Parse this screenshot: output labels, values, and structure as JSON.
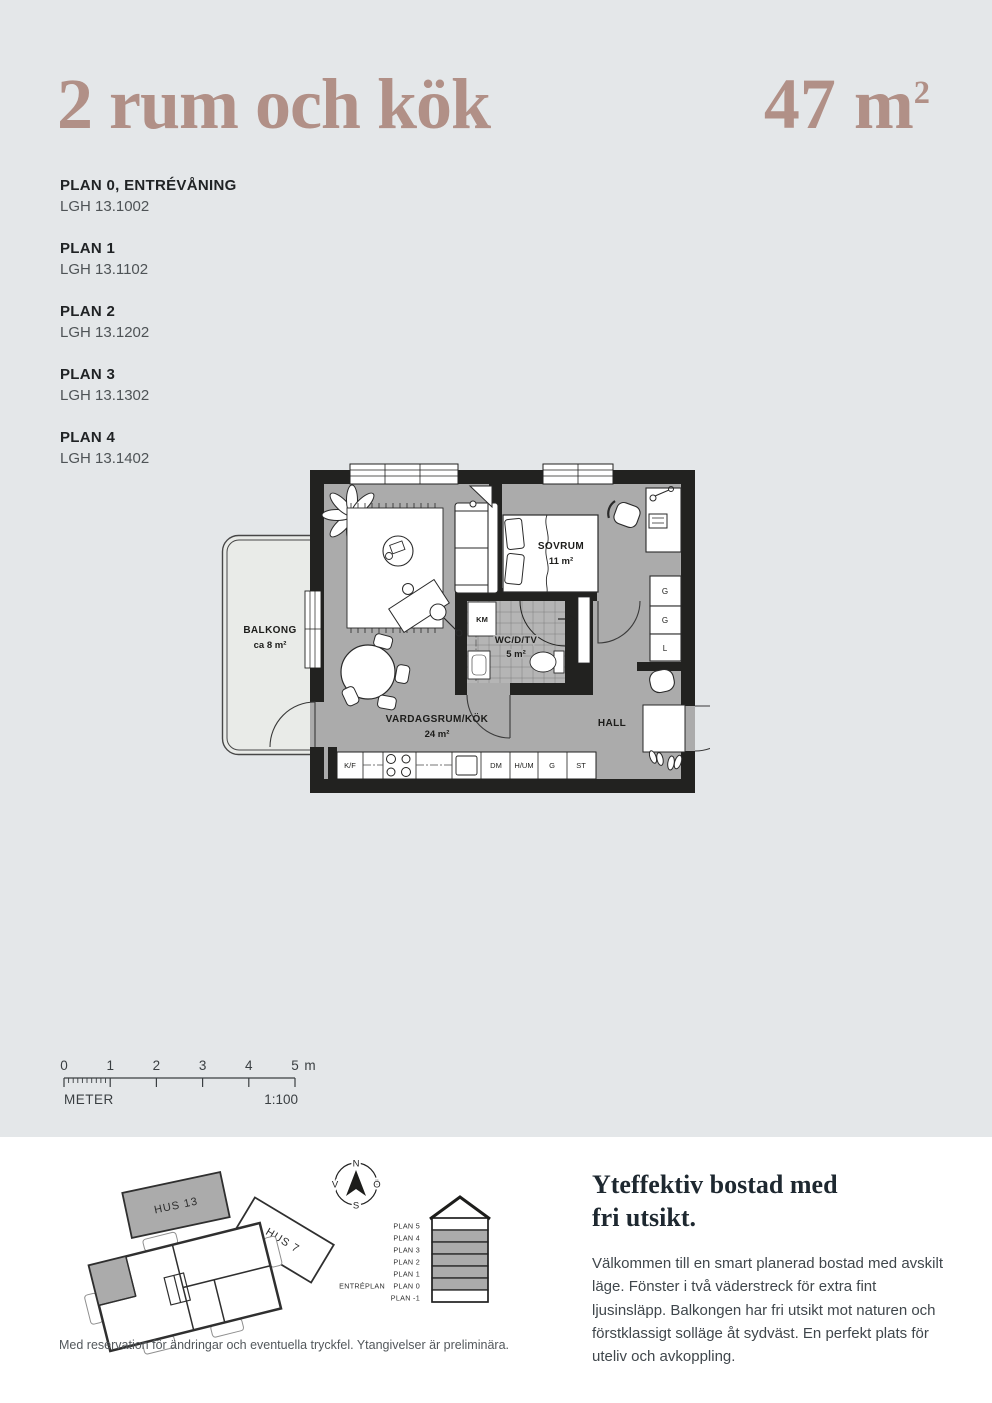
{
  "page": {
    "bg_top": "#e4e7e9",
    "bg_bottom": "#ffffff",
    "accent": "#b19087"
  },
  "header": {
    "title": "2 rum och kök",
    "area_value": "47 m",
    "area_sup": "2"
  },
  "plan_list": [
    {
      "plan": "PLAN 0, ENTRÉVÅNING",
      "lgh": "LGH 13.1002"
    },
    {
      "plan": "PLAN 1",
      "lgh": "LGH 13.1102"
    },
    {
      "plan": "PLAN 2",
      "lgh": "LGH 13.1202"
    },
    {
      "plan": "PLAN 3",
      "lgh": "LGH 13.1302"
    },
    {
      "plan": "PLAN 4",
      "lgh": "LGH 13.1402"
    }
  ],
  "floorplan": {
    "balkong_label": "BALKONG",
    "balkong_area": "ca 8 m²",
    "sovrum_label": "SOVRUM",
    "sovrum_area": "11 m²",
    "wc_label": "WC/D/TV",
    "wc_area": "5 m²",
    "vardagsrum_label": "VARDAGSRUM/KÖK",
    "vardagsrum_area": "24 m²",
    "hall_label": "HALL",
    "km_label": "KM",
    "closets": [
      "G",
      "G",
      "L"
    ],
    "kitchen_units": [
      "K/F",
      "DM",
      "H/UM",
      "G",
      "ST"
    ],
    "colors": {
      "wall": "#222220",
      "floor": "#ababab",
      "balcony": "#e9ebe8",
      "tile": "#b5b5b5"
    }
  },
  "scalebar": {
    "ticks": [
      "0",
      "1",
      "2",
      "3",
      "4",
      "5"
    ],
    "unit": "m",
    "meter_label": "METER",
    "ratio_label": "1:100"
  },
  "site_plan": {
    "hus13_label": "HUS 13",
    "hus7_label": "HUS 7"
  },
  "compass": {
    "north": "N",
    "east": "Ö",
    "south": "S",
    "west": "V"
  },
  "section": {
    "entry_label": "ENTRÉPLAN",
    "floors": [
      {
        "label": "PLAN 5",
        "highlighted": false
      },
      {
        "label": "PLAN 4",
        "highlighted": true
      },
      {
        "label": "PLAN 3",
        "highlighted": true
      },
      {
        "label": "PLAN 2",
        "highlighted": true
      },
      {
        "label": "PLAN 1",
        "highlighted": true
      },
      {
        "label": "PLAN 0",
        "highlighted": true
      },
      {
        "label": "PLAN -1",
        "highlighted": false
      }
    ]
  },
  "info": {
    "heading_line1": "Yteffektiv bostad med",
    "heading_line2": "fri utsikt.",
    "body": "Välkommen till en smart planerad bostad med avskilt läge. Fönster i två väderstreck för extra fint ljusinsläpp. Balkongen har fri utsikt mot naturen och förstklassigt solläge åt sydväst. En perfekt plats för uteliv och avkoppling."
  },
  "footer": {
    "disclaimer": "Med reservation för ändringar och eventuella tryckfel. Ytangivelser är preliminära."
  }
}
